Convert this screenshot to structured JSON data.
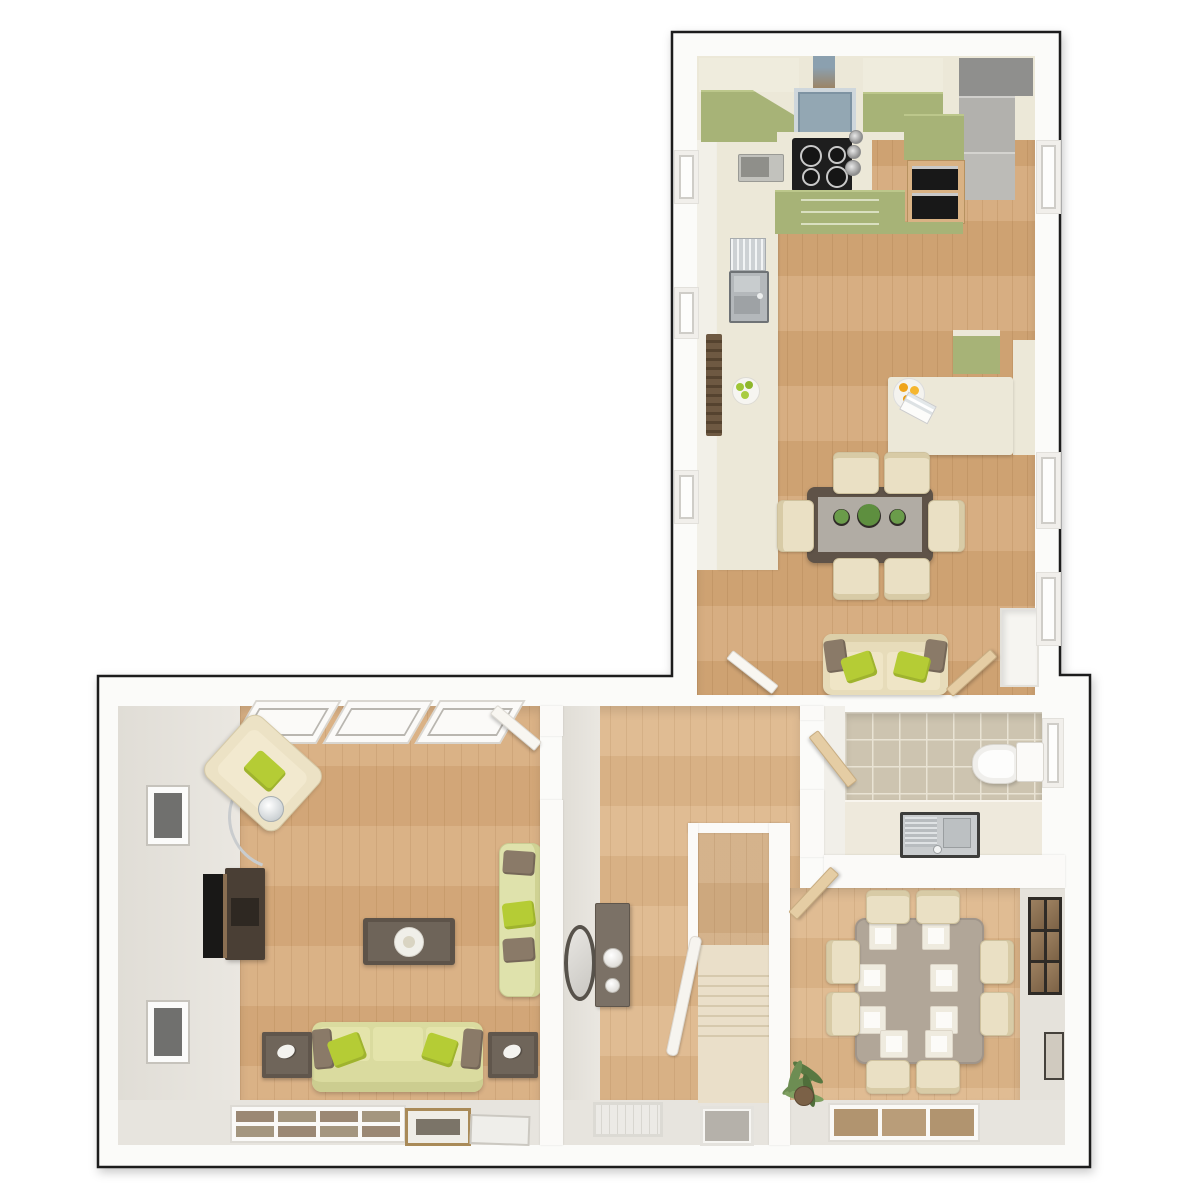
{
  "title": "Ground floor 3D floor plan",
  "view": "top-down dollhouse render, no visible text in image",
  "palette": {
    "background": "#ffffff",
    "outline": "#1c1c1c",
    "wall": "#fbfaf8",
    "wall_face": "#e4e1da",
    "wood_kitchen": "#d4a878",
    "wood_hall": "#ddb68a",
    "wood_living": "#d7ab7c",
    "worktop_cream": "#ece8d8",
    "cabinet_olive": "#a7b377",
    "appliance_gray": "#9c9c9a",
    "hood_blue": "#93a7b3",
    "hob_black": "#1e1e1e",
    "sofa_cream": "#e7dcba",
    "sofa_green": "#dadb9f",
    "pillow_green": "#b5cc35",
    "pillow_brown": "#8a7a68",
    "table_darkwood": "#5f5348",
    "table_taupe": "#b1a698",
    "chair_cream": "#eae0c4",
    "tile_beige": "#cdc4b0",
    "stairs_carpet": "#eadfc9",
    "plant_green": "#6d8d53",
    "orange_juice": "#efa41c"
  },
  "rooms": {
    "kitchen": {
      "label": "Kitchen / breakfast room",
      "furniture": [
        "olive wall and base cabinets",
        "cooker hood",
        "four-ring hob",
        "double oven",
        "fridge freezer",
        "microwave",
        "sink with drainer rack",
        "radiator",
        "fruit bowl",
        "breakfast bar with juice tray",
        "dark wood table for six with plants",
        "cream two-seat sofa",
        "corner store cupboard"
      ]
    },
    "living": {
      "label": "Living room",
      "furniture": [
        "tilted armchair with arc floor lamp",
        "two wall pictures",
        "television and media unit",
        "coffee table with tray",
        "chaise sofa",
        "three-seat sofa",
        "two side tables with ornaments",
        "front bay window",
        "picture frames on sill"
      ]
    },
    "hallway": {
      "label": "Hallway",
      "furniture": [
        "console table with bowls",
        "oval wall mirror",
        "carpeted staircase with banister",
        "front door mat",
        "window"
      ]
    },
    "wc": {
      "label": "Cloakroom WC",
      "furniture": [
        "toilet with cistern",
        "basin unit with drainer",
        "tiled floor",
        "window"
      ]
    },
    "dining": {
      "label": "Dining room",
      "furniture": [
        "taupe table with eight place settings",
        "eight cream chairs",
        "wall shelving unit",
        "small wall frame",
        "window",
        "potted palm plant"
      ]
    }
  }
}
